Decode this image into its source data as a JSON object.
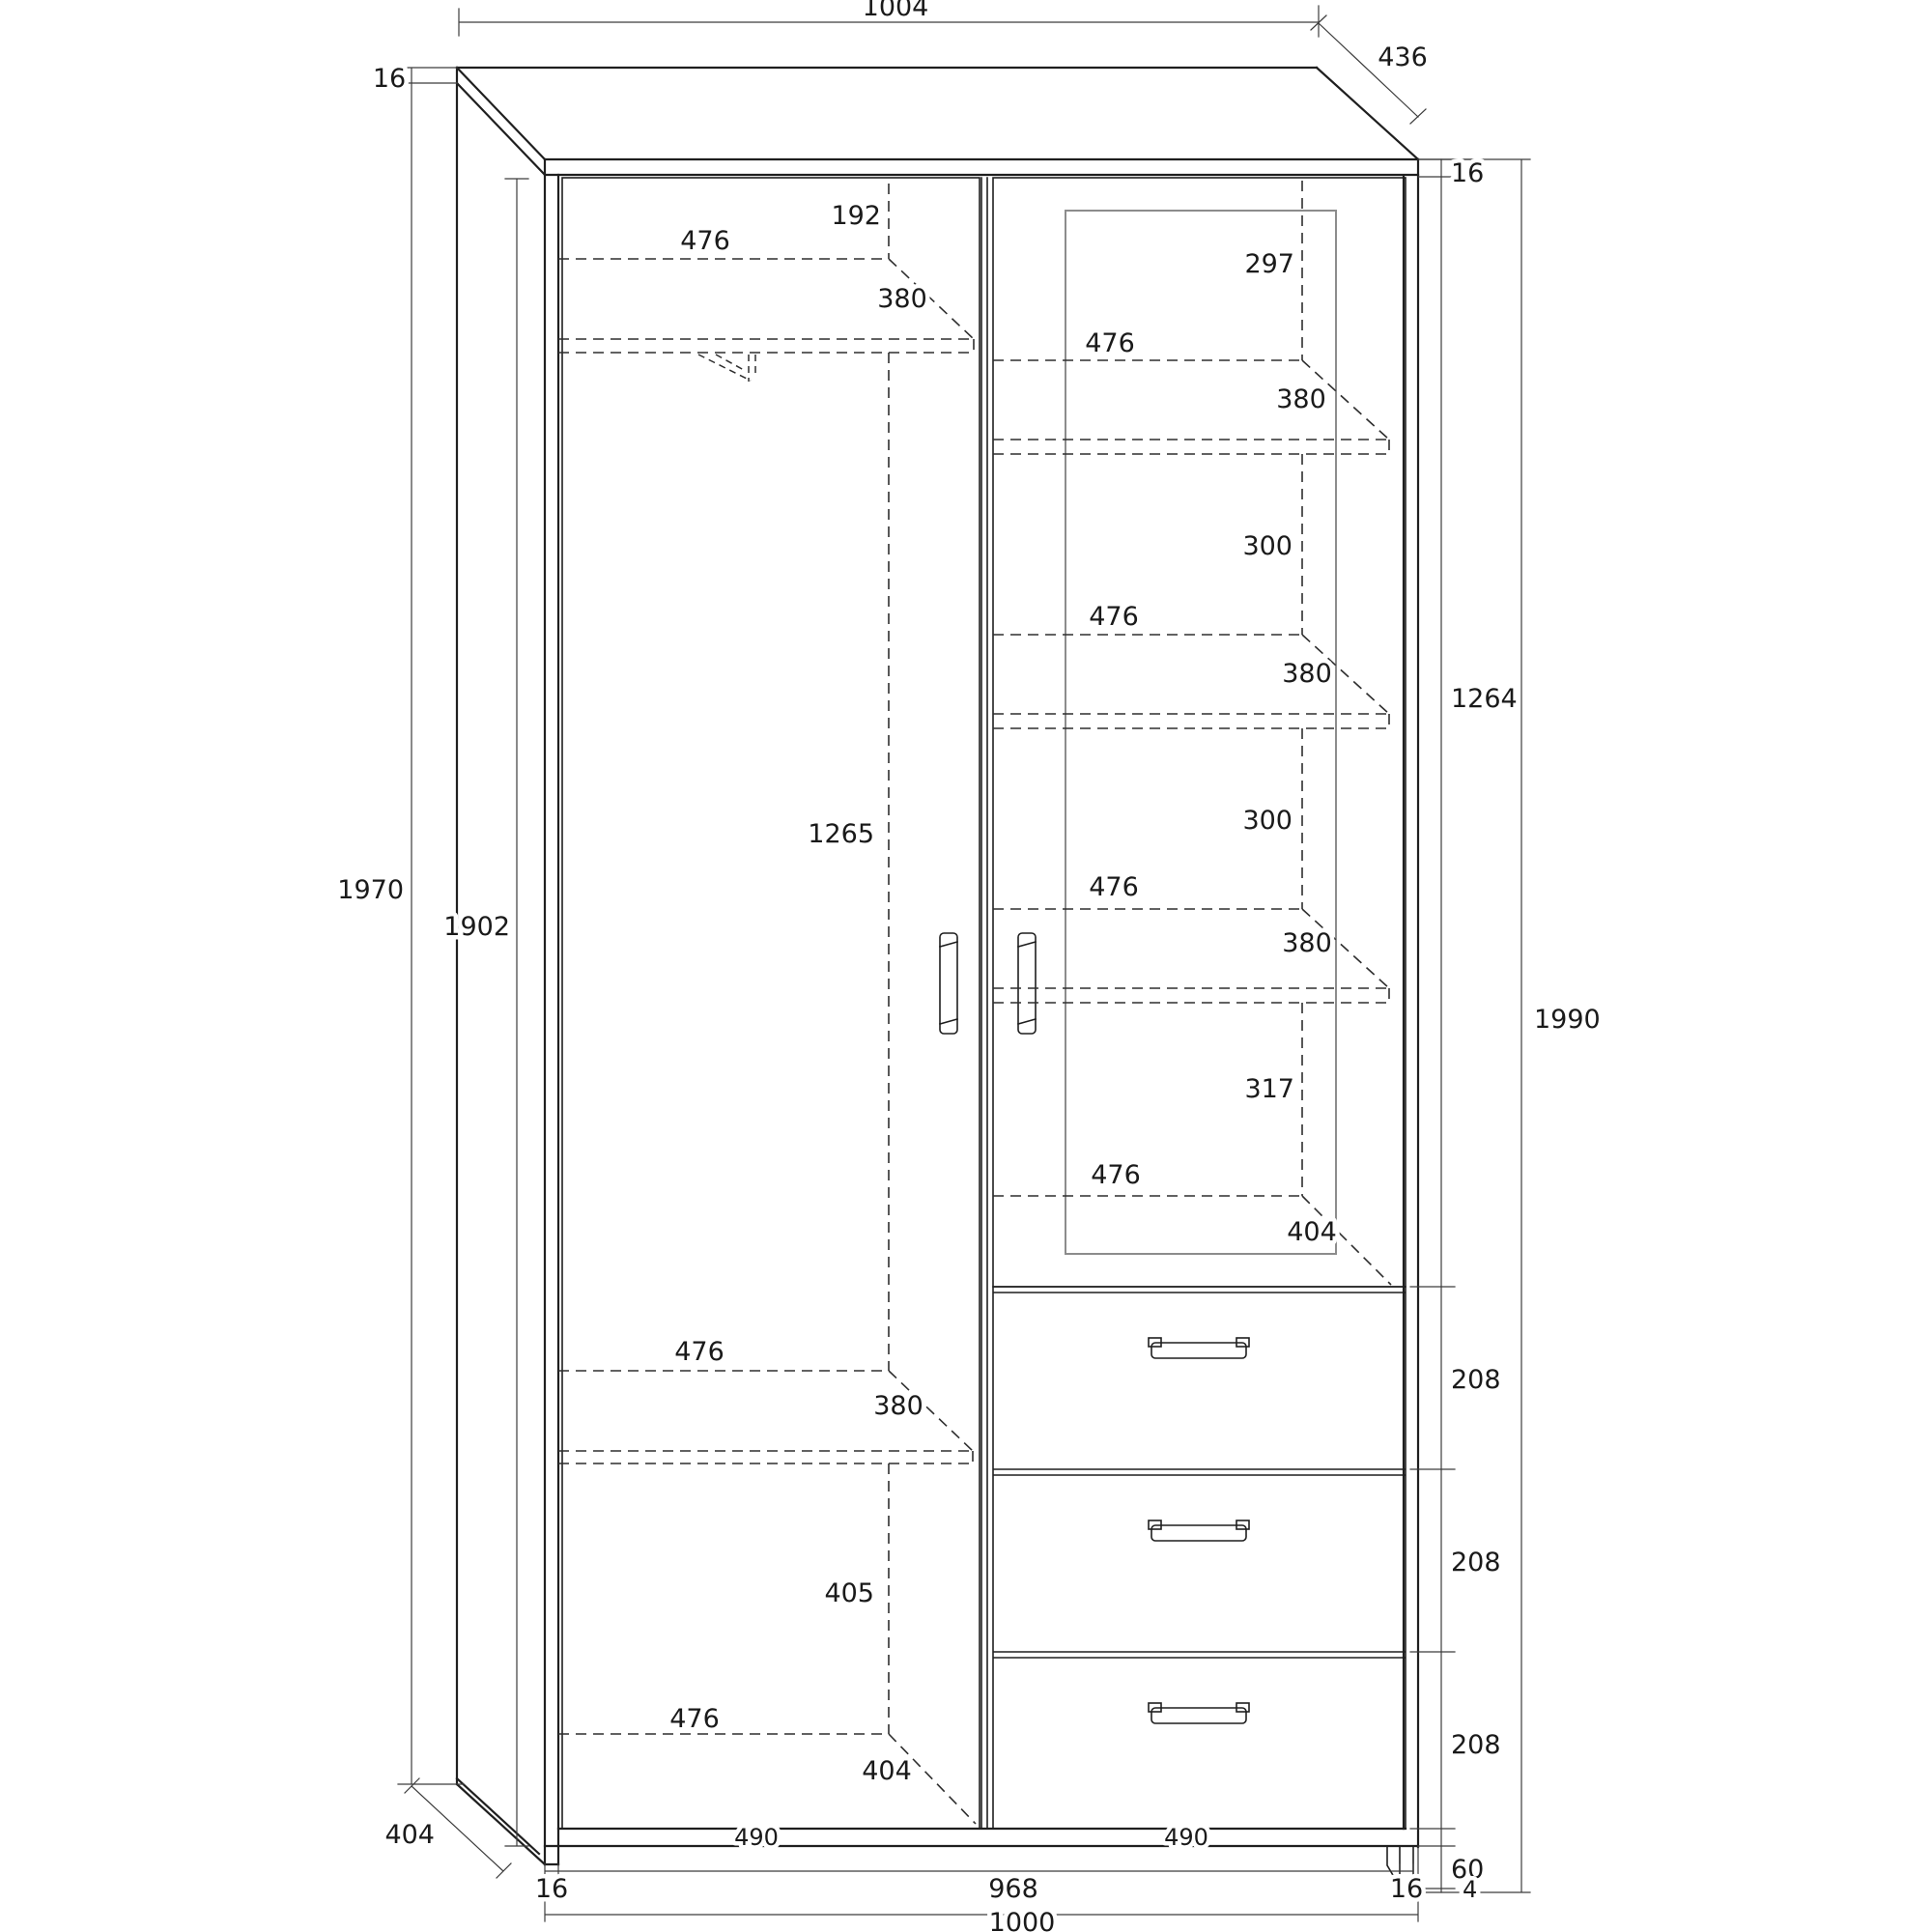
{
  "drawing": {
    "type": "furniture technical drawing",
    "subject": "two-door wardrobe with glass display door, shelves, hanging rod and three drawers",
    "units": "mm"
  },
  "colors": {
    "background": "#ffffff",
    "outline": "#1f1f1f",
    "hidden_line": "#2e2e2e",
    "dimension_line": "#3c3c3c",
    "glass_frame": "#8c8c8c",
    "text": "#1a1a1a"
  },
  "labels": {
    "top_width": "1004",
    "top_depth": "436",
    "top_thickness_left": "16",
    "top_thickness_right": "16",
    "side_height": "1970",
    "inner_height": "1902",
    "side_bottom_depth": "404",
    "upper_section_height": "1264",
    "overall_height": "1990",
    "left_rod_offset": "192",
    "left_shelf1_width": "476",
    "left_shelf1_depth": "380",
    "left_hanging_height": "1265",
    "left_shelf2_width": "476",
    "left_shelf2_depth": "380",
    "left_lower_height": "405",
    "left_floor_width": "476",
    "left_floor_depth": "404",
    "left_bottom_width": "490",
    "right_gap1": "297",
    "right_shelf1_width": "476",
    "right_shelf1_depth": "380",
    "right_gap2": "300",
    "right_shelf2_width": "476",
    "right_shelf2_depth": "380",
    "right_gap3": "300",
    "right_shelf3_width": "476",
    "right_shelf3_depth": "380",
    "right_gap4": "317",
    "right_floor_width": "476",
    "right_floor_depth": "404",
    "right_bottom_width": "490",
    "drawer1_height": "208",
    "drawer2_height": "208",
    "drawer3_height": "208",
    "plinth_height": "60",
    "foot_clearance": "4",
    "bottom_left_thickness": "16",
    "bottom_inner_width": "968",
    "bottom_right_thickness": "16",
    "bottom_total_width": "1000"
  }
}
